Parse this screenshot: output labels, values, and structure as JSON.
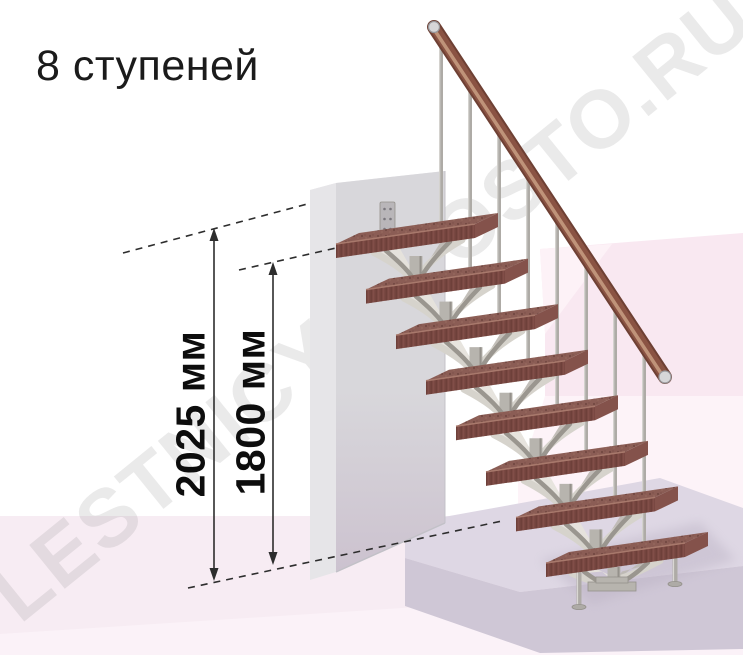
{
  "title": "8 ступеней",
  "steps_count": 8,
  "watermark": "LESTNICY-PROSTO.RU",
  "dimensions": [
    {
      "label": "2025 мм"
    },
    {
      "label": "1800 мм"
    }
  ],
  "figure": {
    "w": 743,
    "h": 655,
    "colors": {
      "bg": "#ffffff",
      "back_wall": "#f9e8f1",
      "back_wall_light": "#fdf3f8",
      "back_wall_hi": "#fdf2f7",
      "floor": "#f7ecf3",
      "floor_front": "#fbf2f8",
      "platform_top": "#ded7e4",
      "platform_front": "#cfc7d6",
      "wall_left": "#e6e5e8",
      "wall_top": "#eceaee",
      "wall_front_a": "#d8d7db",
      "wall_front_b": "#ccc2cf",
      "wall_edge": "#c2c1c7",
      "bracket": "#b9b6b9",
      "bracket_hole": "#7a777d",
      "metal": "#aeaba6",
      "metal_light": "#d9d7d3",
      "metal_dark": "#94918b",
      "spine": "#b7b4ae",
      "frond_light": "#d6d3cc",
      "frond_dark": "#9a968f",
      "frond_fill": "#e6e3dc",
      "frond_fill_dark": "#bcb8b1",
      "step_top": "#8b5d55",
      "step_front": "#794842",
      "step_end": "#84524b",
      "step_edge": "#a8796c",
      "speck_dark": "#5e3933",
      "speck_light": "#9e7365",
      "grain": "#633731",
      "grain_light": "#8a564d",
      "rail": "#8a5343",
      "rail_hi": "#c59a7f",
      "rail_dark": "#6e4034",
      "cap_fill": "#d6d6d8",
      "cap_edge": "#97979b",
      "line": "#2d2d2d",
      "shadow": "#b9b0c2",
      "watermark": "#7d7d7d"
    },
    "bg_shapes": {
      "back_wall": [
        [
          540,
          249
        ],
        [
          743,
          233
        ],
        [
          743,
          396
        ],
        [
          545,
          396
        ],
        [
          545,
          332
        ]
      ],
      "back_wall_light": [
        [
          545,
          396
        ],
        [
          743,
          396
        ],
        [
          743,
          524
        ],
        [
          518,
          524
        ],
        [
          518,
          483
        ]
      ],
      "back_wall_hi": [
        [
          540,
          249
        ],
        [
          612,
          244
        ],
        [
          545,
          334
        ]
      ],
      "floor": [
        [
          0,
          516
        ],
        [
          743,
          516
        ],
        [
          743,
          655
        ],
        [
          0,
          655
        ]
      ],
      "floor_front": [
        [
          0,
          634
        ],
        [
          743,
          586
        ],
        [
          743,
          655
        ],
        [
          0,
          655
        ]
      ]
    },
    "platform": {
      "top": [
        [
          405,
          524
        ],
        [
          660,
          478
        ],
        [
          743,
          508
        ],
        [
          743,
          566
        ],
        [
          520,
          592
        ],
        [
          405,
          558
        ]
      ],
      "front": [
        [
          405,
          558
        ],
        [
          520,
          592
        ],
        [
          743,
          566
        ],
        [
          743,
          649
        ],
        [
          540,
          653
        ],
        [
          405,
          606
        ]
      ],
      "shadow": [
        [
          540,
          560
        ],
        [
          700,
          522
        ],
        [
          736,
          560
        ],
        [
          592,
          604
        ]
      ]
    },
    "wall": {
      "left": [
        [
          310,
          190
        ],
        [
          336,
          183
        ],
        [
          336,
          572
        ],
        [
          310,
          580
        ]
      ],
      "top": [
        [
          310,
          190
        ],
        [
          336,
          183
        ],
        [
          445,
          171
        ],
        [
          445,
          175
        ],
        [
          336,
          188
        ],
        [
          310,
          194
        ]
      ],
      "front": [
        [
          336,
          183
        ],
        [
          445,
          171
        ],
        [
          445,
          523
        ],
        [
          336,
          572
        ]
      ],
      "bottom_edge": [
        336,
        572,
        445,
        523
      ],
      "bracket": {
        "x": 380,
        "y": 202,
        "w": 15,
        "h": 34,
        "holes": [
          [
            384.5,
            209
          ],
          [
            390.5,
            209
          ],
          [
            384.5,
            219
          ],
          [
            390.5,
            219
          ],
          [
            384.5,
            229
          ],
          [
            390.5,
            229
          ]
        ]
      }
    },
    "steps": {
      "count": 8,
      "x0": 546,
      "y0": 563,
      "dx": -30,
      "dy": -45.57,
      "len": 139,
      "rise": -20,
      "depth_x": 23,
      "depth_y": -11,
      "front_h": 14
    },
    "spine": {
      "dx_from_lower": 50,
      "width": 13
    },
    "balusters": {
      "x0": 441,
      "spacing": 29,
      "surface_slope": -0.1439
    },
    "rail": {
      "x1": 434,
      "y1": 27,
      "x2": 665,
      "y2": 377,
      "width": 12
    },
    "legs": [
      {
        "x": 579,
        "y1": 570,
        "y2": 606
      },
      {
        "x": 675,
        "y1": 556,
        "y2": 583
      }
    ],
    "base_plate": {
      "plates": [
        [
          588,
          582,
          48,
          9
        ],
        [
          596,
          577,
          32,
          6
        ]
      ],
      "col": {
        "cx": 614,
        "y1": 567,
        "y2": 580
      }
    },
    "dashes": [
      [
        123,
        253,
        311,
        203
      ],
      [
        239,
        270,
        336,
        248
      ],
      [
        188,
        588,
        502,
        521
      ]
    ],
    "dims": [
      {
        "x": 214,
        "tip1": 228,
        "tip2": 581
      },
      {
        "x": 273,
        "tip1": 262,
        "tip2": 565
      }
    ],
    "watermark_pos": {
      "x": 20,
      "y": 625,
      "rotate": -39,
      "size": 82,
      "opacity": 0.16,
      "letter_spacing": 2
    }
  }
}
